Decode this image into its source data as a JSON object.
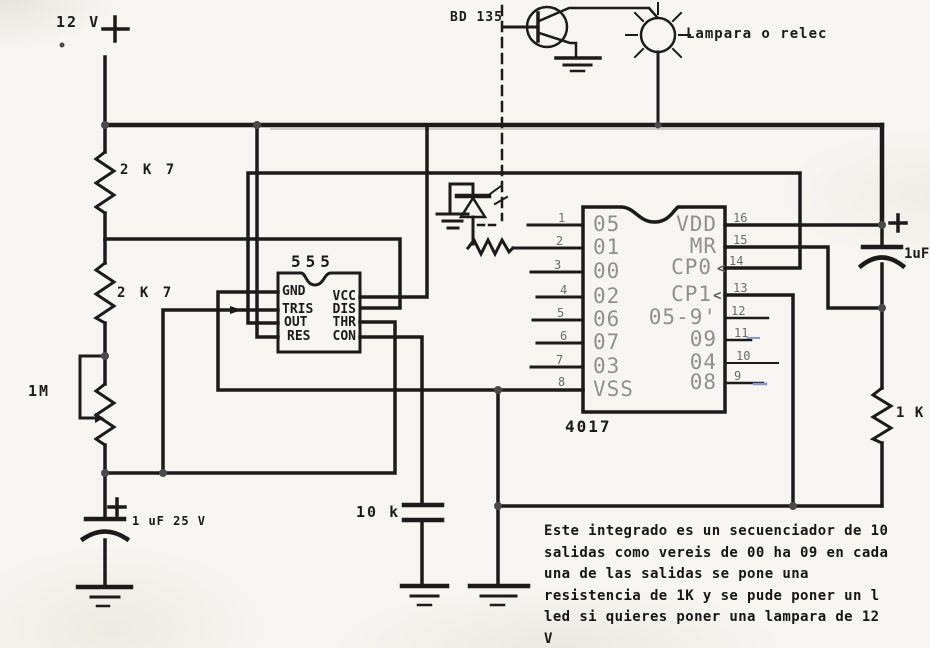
{
  "colors": {
    "ink": "#1b1b1b",
    "ink_soft": "#4a4a4a",
    "paper": "#f6f5f1",
    "chip_text": "#8f8f8f",
    "pin_num": "#6b6b6b",
    "blue_mark": "#8a93d6"
  },
  "power": {
    "voltage": "12 V"
  },
  "transistor": {
    "part": "BD 135"
  },
  "lamp": {
    "label": "Lampara o relec"
  },
  "resistors": {
    "r1": "2 K 7",
    "r2": "2 K 7",
    "r3": "1M",
    "r4": "1 K"
  },
  "capacitors": {
    "c1": "1 uF 25 V",
    "c2": "1uF",
    "c3": "10 k"
  },
  "timer": {
    "part": "555",
    "pins_left": [
      "GND",
      "TRIS",
      "OUT",
      "RES"
    ],
    "pins_right": [
      "VCC",
      "DIS",
      "THR",
      "CON"
    ]
  },
  "counter": {
    "part": "4017",
    "clock_chevron": "<",
    "pins_left": [
      {
        "num": "1",
        "label": "05"
      },
      {
        "num": "2",
        "label": "01"
      },
      {
        "num": "3",
        "label": "00"
      },
      {
        "num": "4",
        "label": "02"
      },
      {
        "num": "5",
        "label": "06"
      },
      {
        "num": "6",
        "label": "07"
      },
      {
        "num": "7",
        "label": "03"
      },
      {
        "num": "8",
        "label": "VSS"
      }
    ],
    "pins_right": [
      {
        "num": "16",
        "label": "VDD"
      },
      {
        "num": "15",
        "label": "MR"
      },
      {
        "num": "14",
        "label": "CP0"
      },
      {
        "num": "13",
        "label": "CP1"
      },
      {
        "num": "12",
        "label": "05-9'"
      },
      {
        "num": "11",
        "label": "09"
      },
      {
        "num": "10",
        "label": "04"
      },
      {
        "num": "9",
        "label": "08"
      }
    ]
  },
  "note": "Este integrado es un secuenciador de 10\nsalidas como vereis de 00 ha 09 en cada\nuna de las salidas se pone una\nresistencia de 1K y se pude poner un l\nled si quieres poner una lampara de 12 V\no un relec hay que montar un BD 135"
}
